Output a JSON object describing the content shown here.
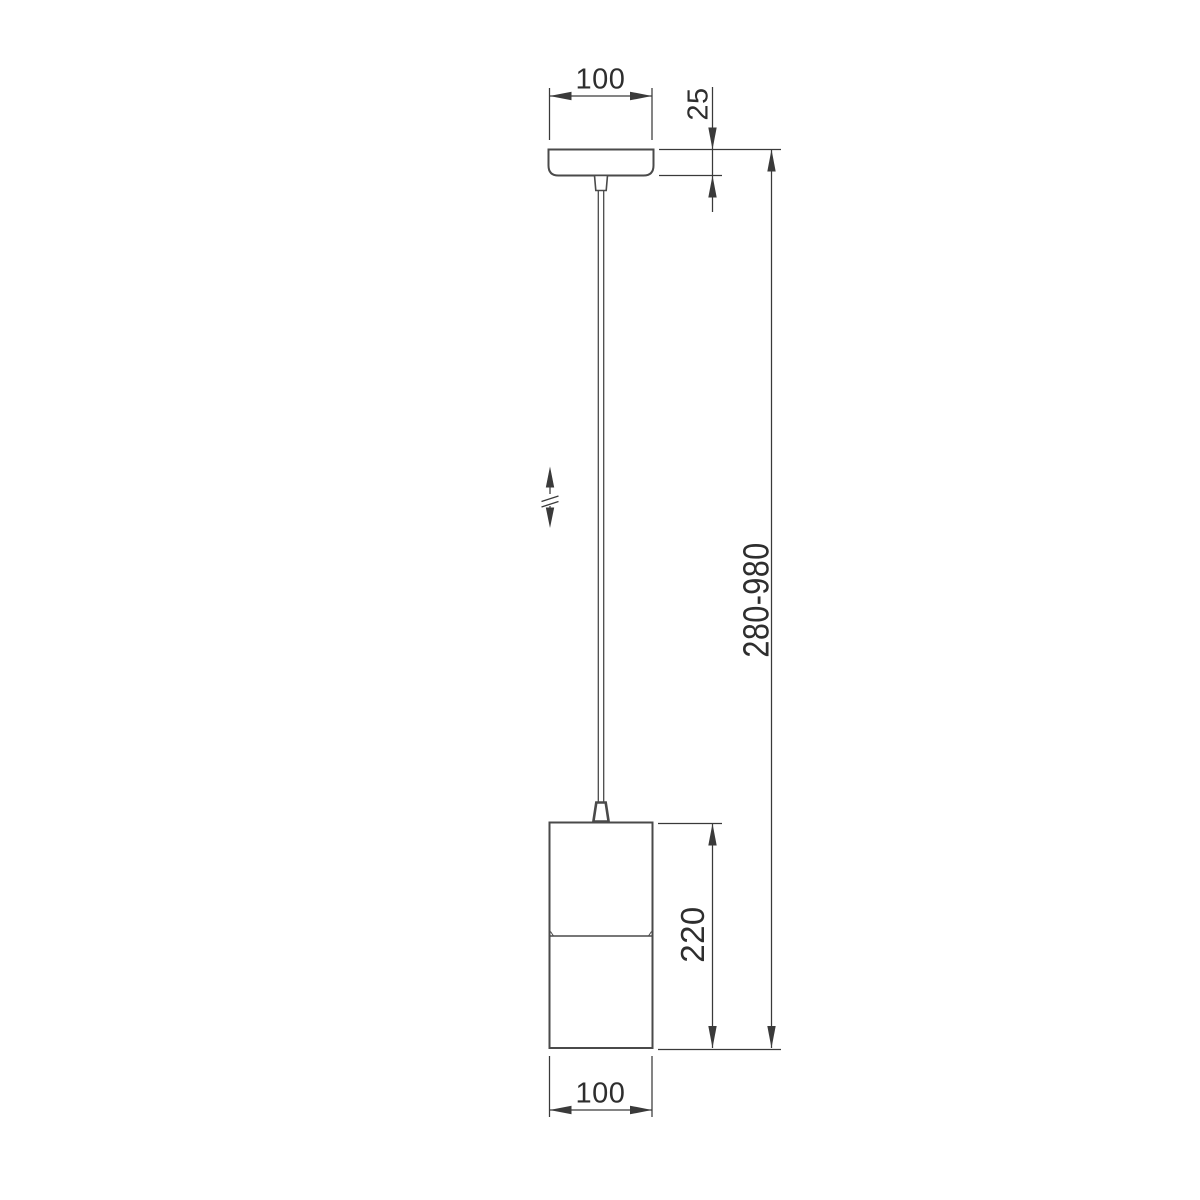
{
  "drawing": {
    "object": "pendant-lamp-dimension-drawing",
    "background": "#ffffff",
    "line_color": "#4a4a4a",
    "dimension_line_color": "#3a3a3a",
    "text_color": "#2e2e2e",
    "dimensions": {
      "canopy_width": "100",
      "canopy_height": "25",
      "overall_height_range": "280-980",
      "body_height": "220",
      "body_width": "100"
    }
  }
}
